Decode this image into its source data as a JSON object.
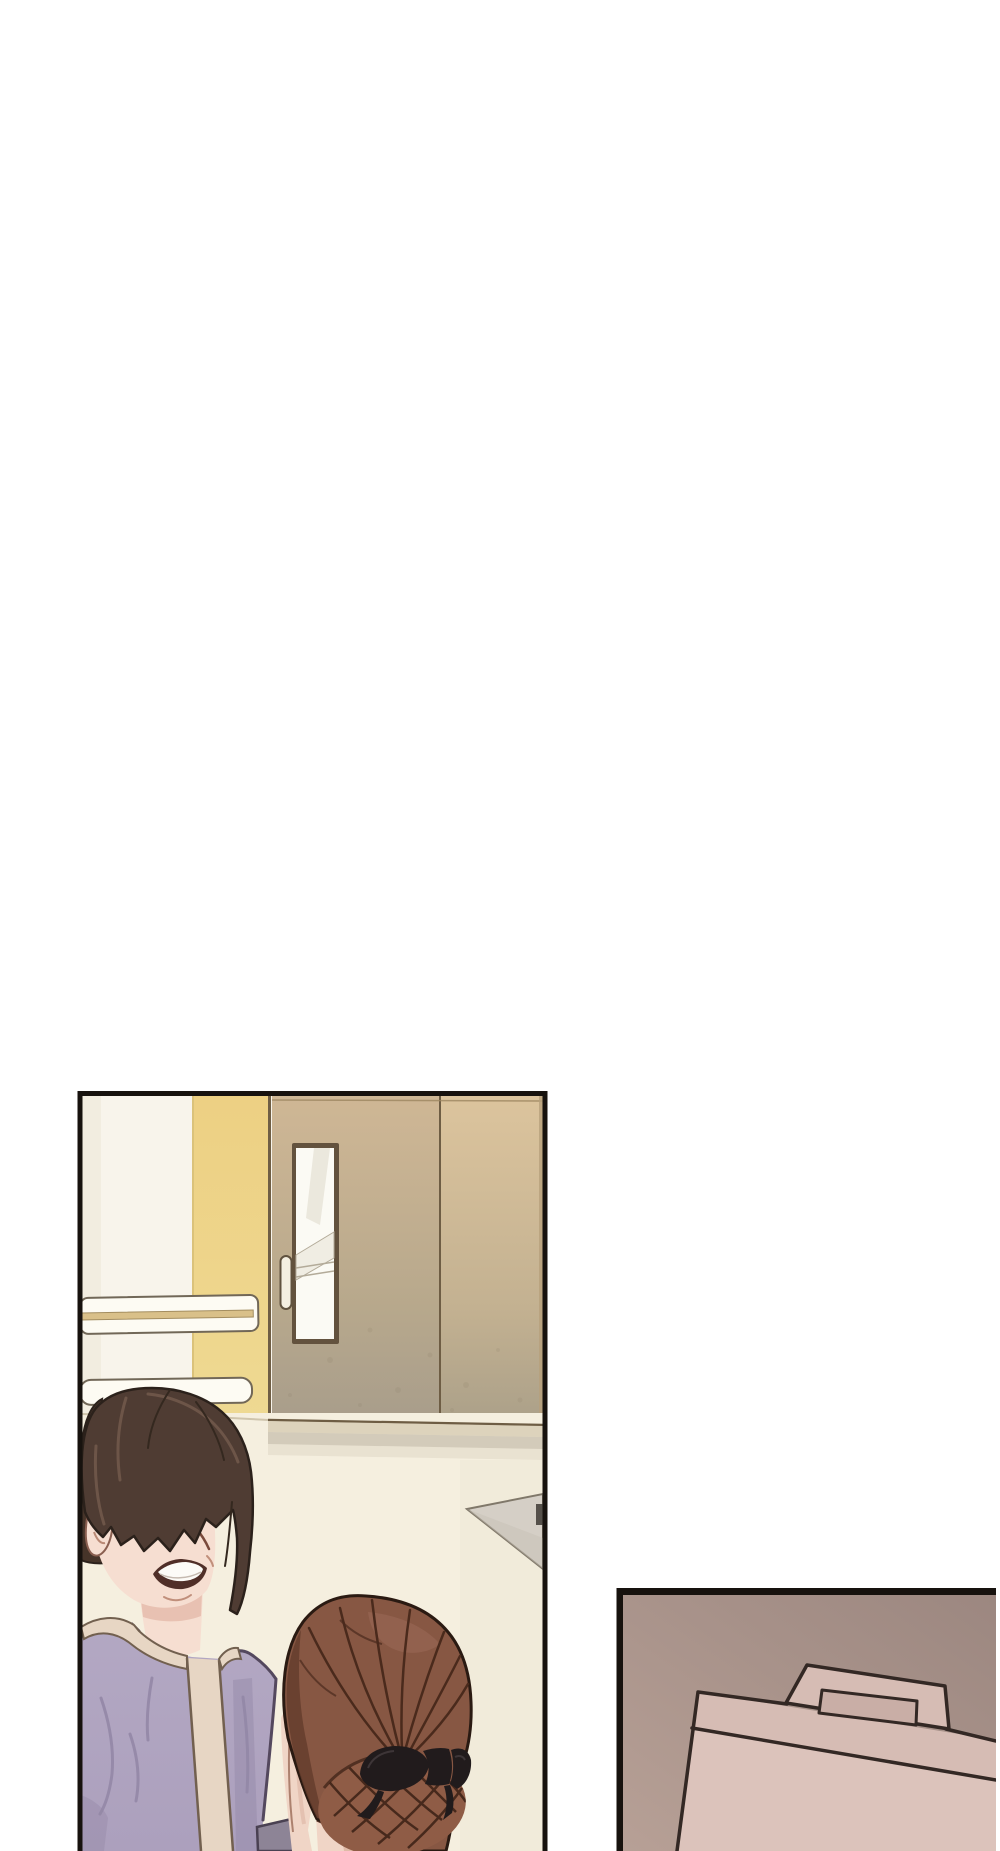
{
  "page": {
    "background": "#ffffff",
    "panel_count": 2
  },
  "colors": {
    "ink": "#17120e",
    "wall_white": "#f8f4eb",
    "wall_white_shade": "#efe9db",
    "wall_yellow_1": "#edd083",
    "wall_yellow_2": "#eed992",
    "yellow_edge": "#dbc27a",
    "frame_line": "#6f5e45",
    "door_l_1": "#cfb795",
    "door_l_2": "#b7a88c",
    "door_l_3": "#a89d8b",
    "door_r_1": "#dcc49d",
    "door_r_2": "#c3b191",
    "door_r_3": "#aba089",
    "door_line": "#9d8660",
    "door_seam": "#6e5d44",
    "door_edge": "#b6a07c",
    "speckle": "#857862",
    "window_frame": "#63523e",
    "window_glass": "#fbfaf4",
    "window_refl": "#ebe8dd",
    "window_refl2": "#f0ede3",
    "window_line": "#b3ab99",
    "handle_fill": "#f4efe1",
    "handle_line": "#60523f",
    "rail_fill": "#fdfbf3",
    "rail_line": "#716757",
    "rail_stripe": "#d9c089",
    "rail_stripe_line": "#a38d5f",
    "floor": "#f5efdf",
    "wall_floor_line": "#cfc5ad",
    "baseboard": "#ddd3bc",
    "floor_shadow": "#b7ad9a",
    "floor_shade": "#ece4d2",
    "obj_gray": "#d5cfc6",
    "obj_gray_dark": "#c8c1b5",
    "obj_outline": "#80786a",
    "obj_bar": "#55504a",
    "hair1": "#4f3c33",
    "hair1_back": "#463429",
    "hair1_dark": "#2b211b",
    "hair1_strand": "#34281f",
    "hair1_hi": "#70584a",
    "skin": "#f6ded1",
    "skin_shadow": "#e3b7a7",
    "skin_line": "#b98975",
    "ear_line": "#8a5f50",
    "nose_line": "#7a4a3c",
    "cheek_line": "#c08f7b",
    "mouth_dark": "#502f28",
    "teeth": "#fcfbf7",
    "teeth_line": "#c5bab0",
    "shirt_1": "#b3a8c3",
    "shirt_2": "#aca0bd",
    "shirt_fold": "#9387a6",
    "shirt_outline": "#54485e",
    "trim": "#e7d6c4",
    "trim_line": "#72604f",
    "cuff": "#8d8496",
    "cuff_line": "#4a4152",
    "skin2": "#f0d5c6",
    "skin2_shadow": "#d8ae9b",
    "skin2_line": "#9b6b57",
    "skin2_dark": "#4f2d20",
    "neck_shade": "#d4a892",
    "hair2": "#875743",
    "hair2_dark": "#653d2d",
    "hair2_hi": "#a06f5e",
    "hair2_line": "#4a2a1c",
    "hair2_outline": "#2a1a12",
    "bun": "#8f5c46",
    "bun_line": "#47291c",
    "bun_shadow": "#3a2014",
    "bow": "#211b1c",
    "bow_hi": "#3d3537",
    "p2_bg_1": "#9c8780",
    "p2_bg_2": "#b7a096",
    "bag": "#d6bcb4",
    "bag_front": "#dcc3bb",
    "bag_hole": "#c9aea6",
    "bag_line": "#332824"
  }
}
